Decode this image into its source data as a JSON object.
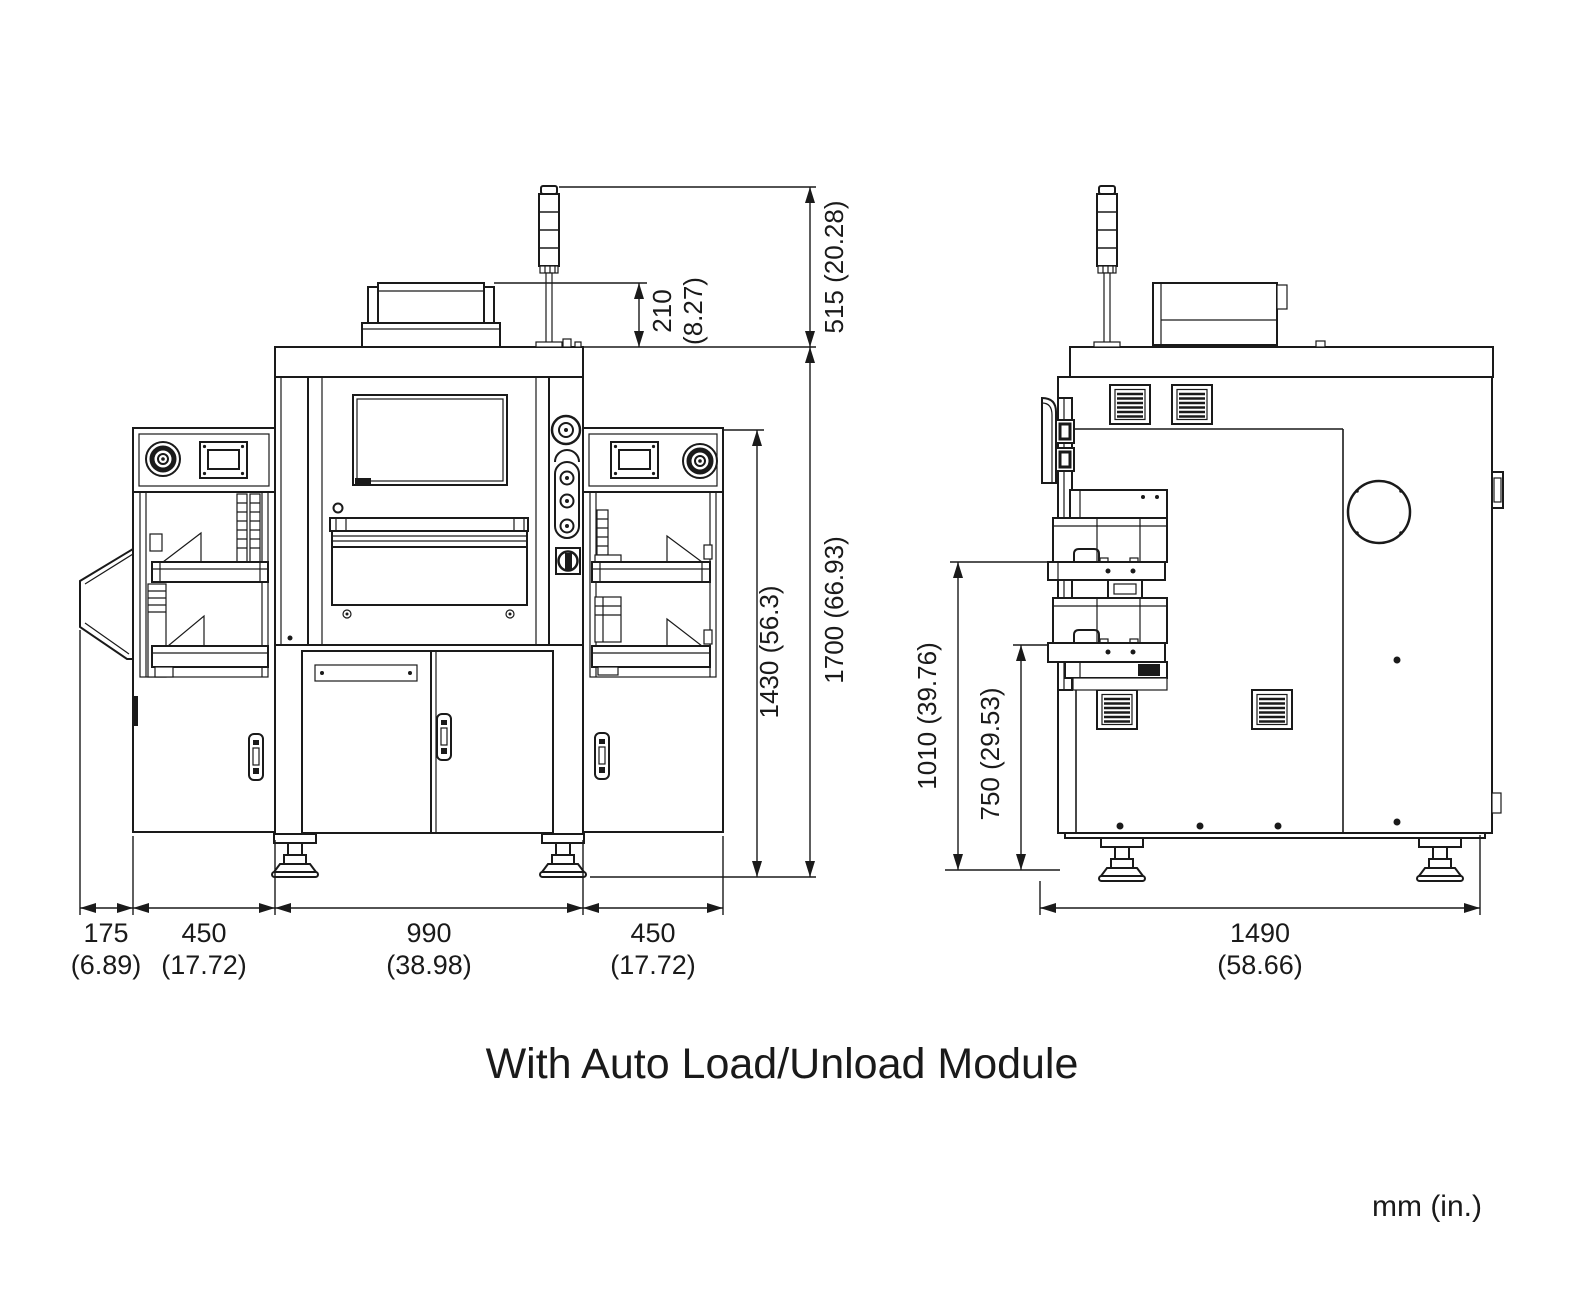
{
  "drawing": {
    "caption": "With Auto Load/Unload Module",
    "units_label": "mm (in.)"
  },
  "front_view": {
    "dimensions": {
      "signal_tower_top_to_machine_top": "515 (20.28)",
      "monitor_top_to_machine_top_mm": "210",
      "monitor_top_to_machine_top_in": "(8.27)",
      "loader_top_to_floor": "1430 (56.3)",
      "overall_height": "1700 (66.93)",
      "side_flap_depth_mm": "175",
      "side_flap_depth_in": "(6.89)",
      "left_loader_width_mm": "450",
      "left_loader_width_in": "(17.72)",
      "main_body_width_mm": "990",
      "main_body_width_in": "(38.98)",
      "right_loader_width_mm": "450",
      "right_loader_width_in": "(17.72)"
    }
  },
  "side_view": {
    "dimensions": {
      "upper_conveyor_height": "1010 (39.76)",
      "lower_conveyor_height": "750 (29.53)",
      "overall_depth_mm": "1490",
      "overall_depth_in": "(58.66)"
    }
  }
}
